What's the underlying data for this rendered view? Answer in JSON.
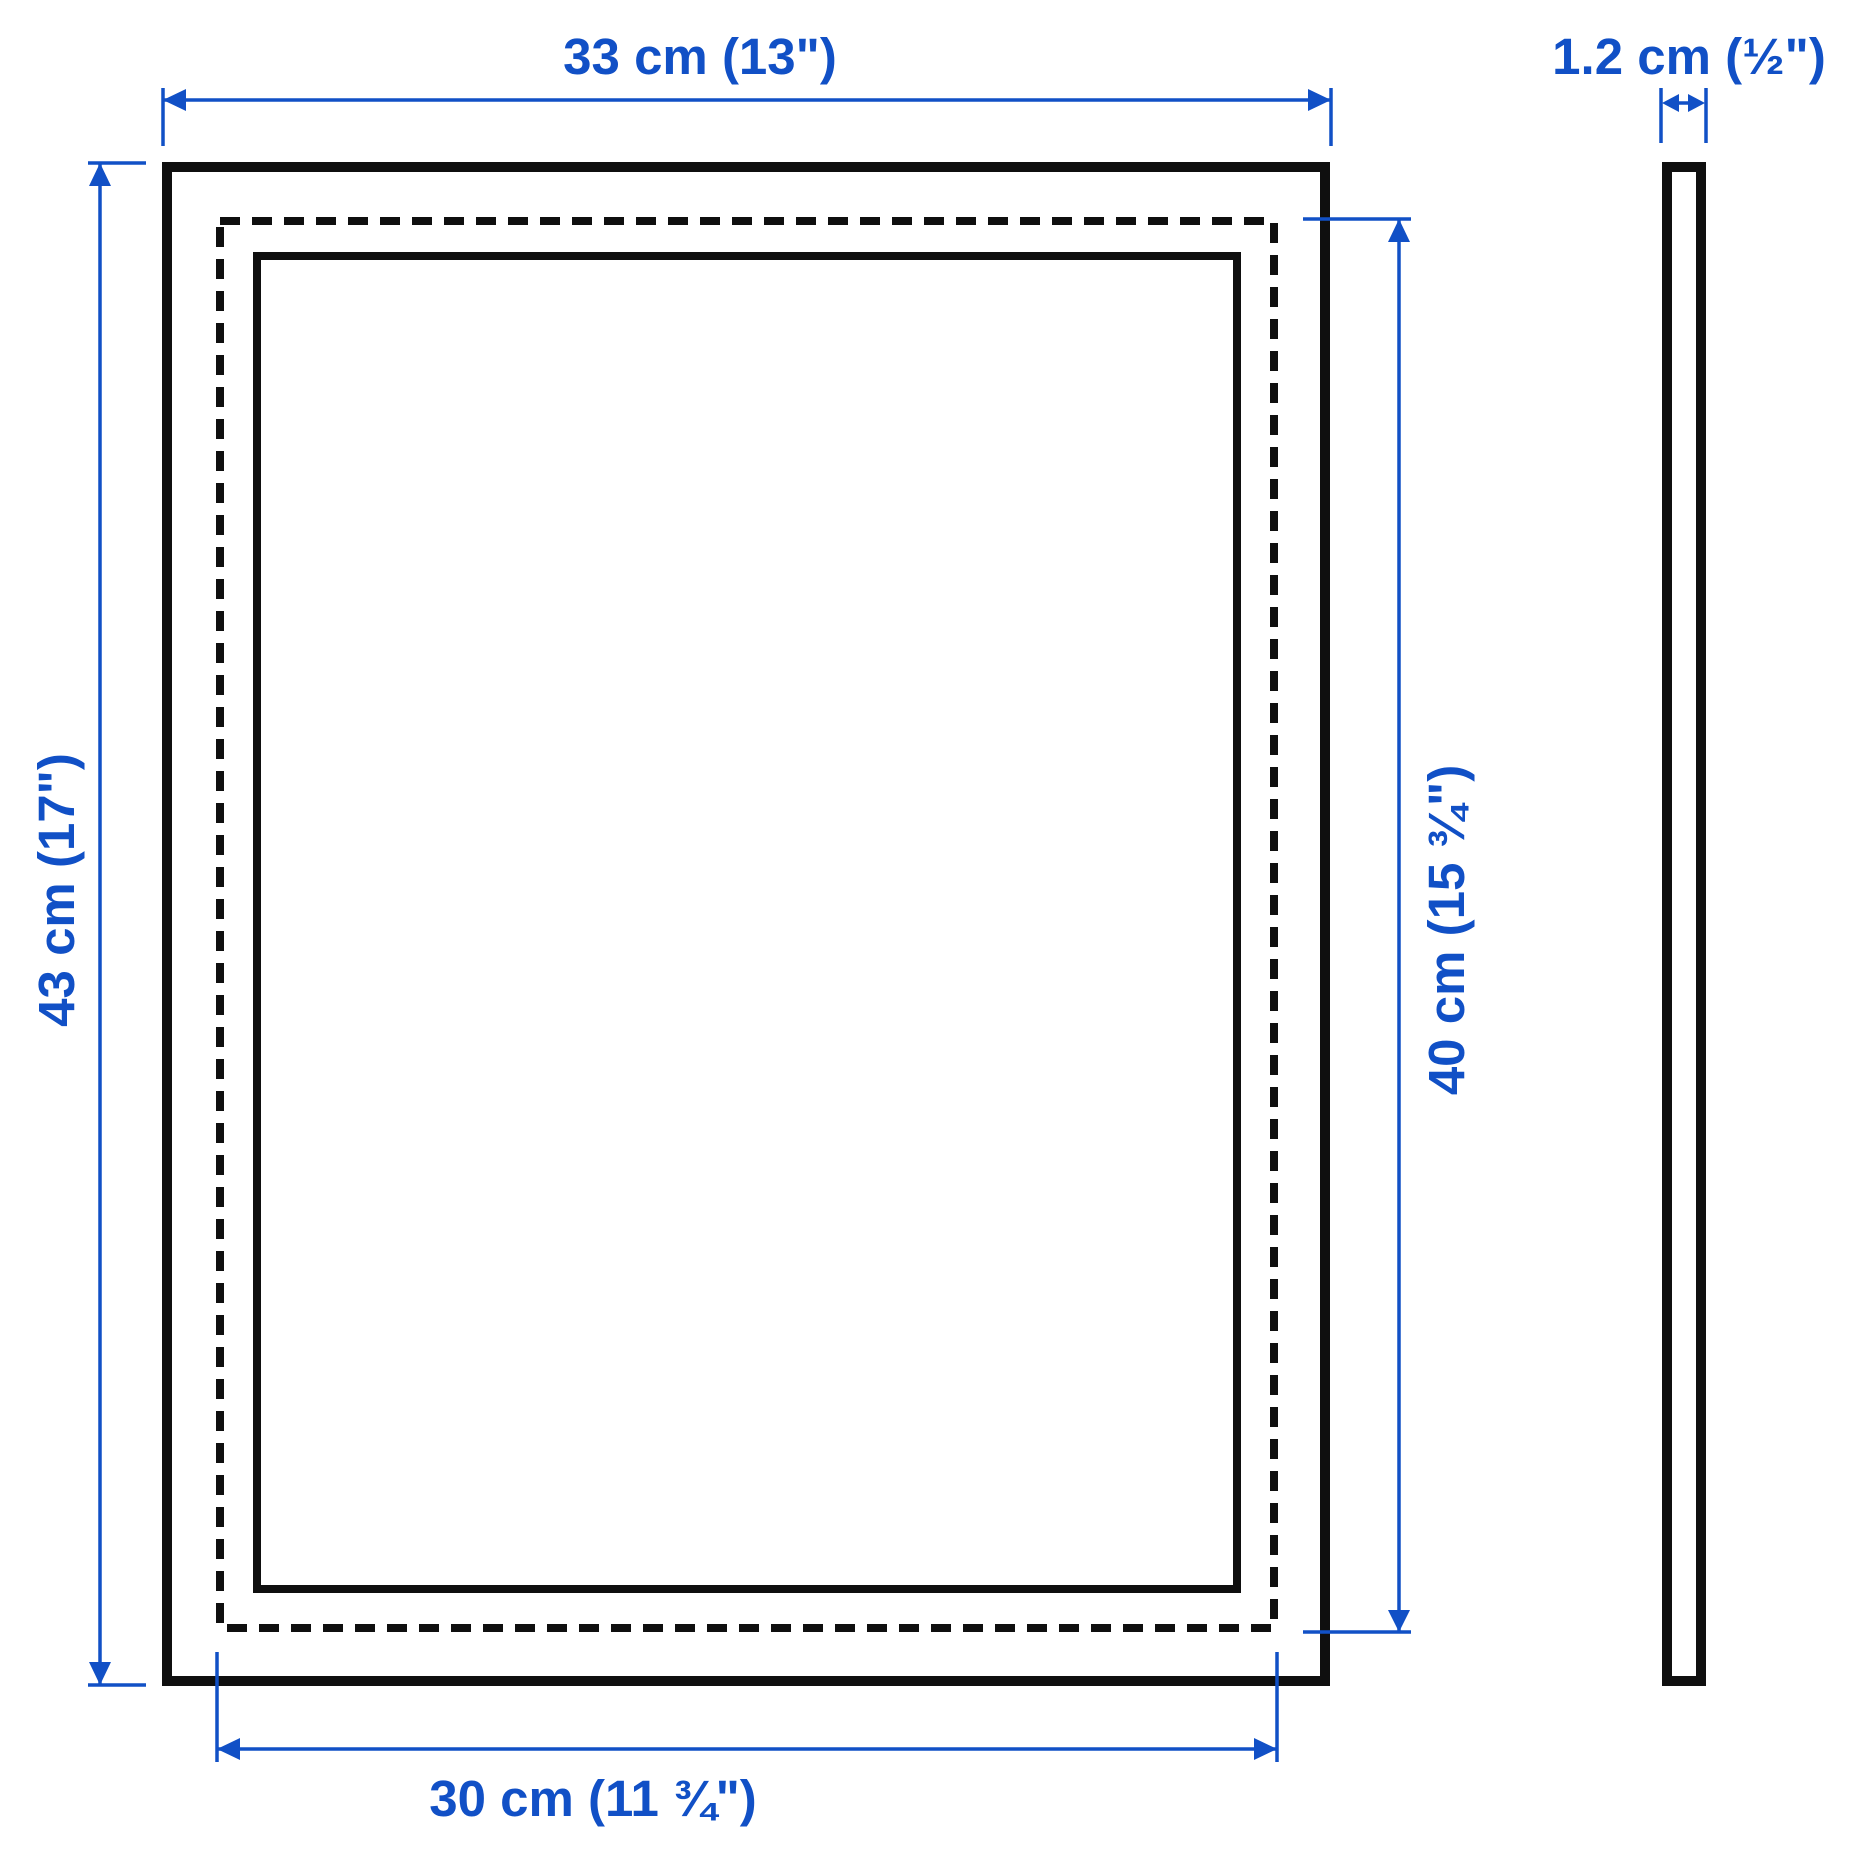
{
  "colors": {
    "dimension_blue": "#1150c6",
    "outline_black": "#0f0f0f",
    "background": "#ffffff"
  },
  "dimensions": {
    "frame_width": "33 cm (13\")",
    "frame_height": "43 cm (17\")",
    "picture_height": "40 cm (15 ¾\")",
    "picture_width": "30 cm (11 ¾\")",
    "frame_depth": "1.2 cm (½\")"
  }
}
